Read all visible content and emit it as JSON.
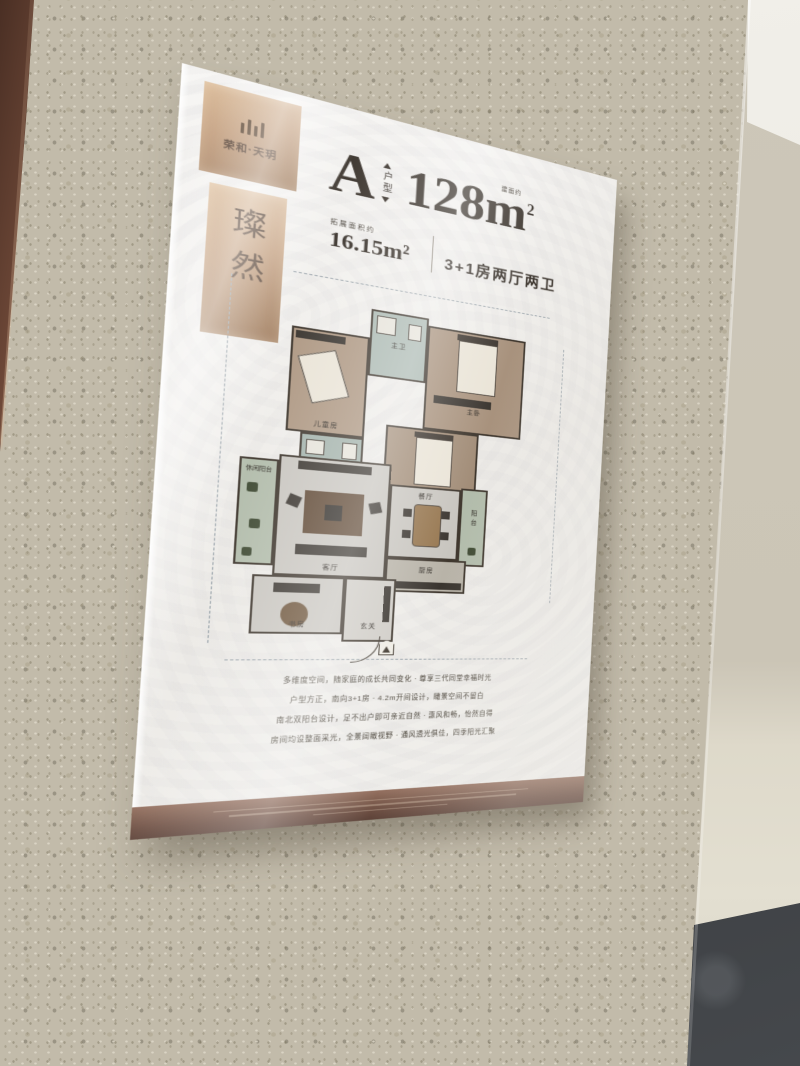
{
  "poster": {
    "brand": {
      "logo_text": "荣和·天玥",
      "name_vertical": "璨然"
    },
    "headline": {
      "unit_letter": "A",
      "unit_label": "户型",
      "area_prefix": "建面约",
      "area_value": "128m",
      "area_sup": "2",
      "extra_area_label": "拓展面积约",
      "extra_area_value": "16.15m²",
      "layout_text": "3+1房两厅两卫"
    },
    "floorplan": {
      "rooms": [
        {
          "id": "master-bath",
          "label": "主卫"
        },
        {
          "id": "master-bedroom",
          "label": "主卧"
        },
        {
          "id": "children-room",
          "label": "儿童房"
        },
        {
          "id": "bathroom",
          "label": "卫生间"
        },
        {
          "id": "elder-room",
          "label": "老人房"
        },
        {
          "id": "leisure-balcony",
          "label": "休闲阳台"
        },
        {
          "id": "living-room",
          "label": "客厅"
        },
        {
          "id": "dining-room",
          "label": "餐厅"
        },
        {
          "id": "balcony",
          "label": "阳台"
        },
        {
          "id": "kitchen",
          "label": "厨房"
        },
        {
          "id": "study",
          "label": "书房"
        },
        {
          "id": "foyer",
          "label": "玄关"
        }
      ]
    },
    "description_lines": [
      "多维度空间，随家庭的成长共同变化 · 尊享三代同堂幸福时光",
      "户型方正，南向3+1房 · 4.2m开间设计，瞰景空间不留白",
      "南北双阳台设计，足不出户即可亲近自然 · 惠风和畅，怡然自得",
      "房间均设整面采光，全景阔瞰视野 · 通风透光俱佳，四季阳光汇聚"
    ],
    "colors": {
      "bronze": "#c09a78",
      "band_brown": "#6b4d41",
      "ink": "#3a332c",
      "wall_speckle": "#c2bbaa"
    }
  }
}
